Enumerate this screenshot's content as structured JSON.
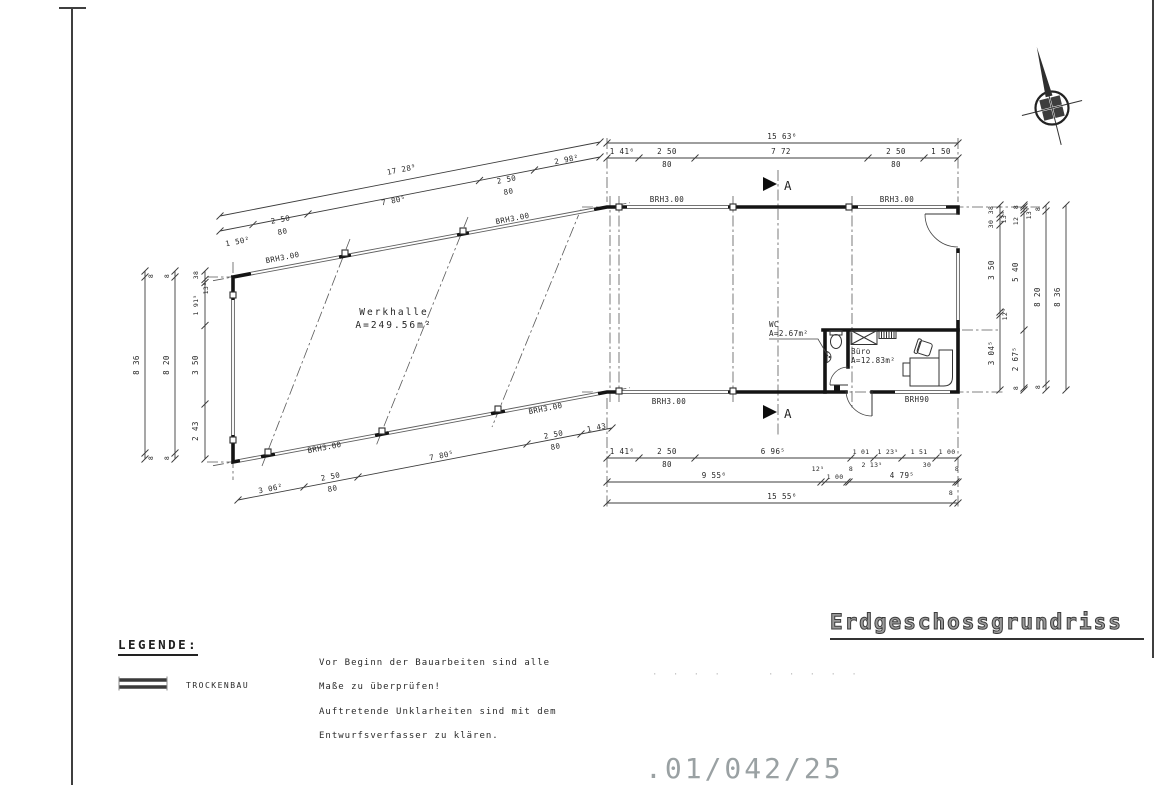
{
  "sheet": {
    "title": "Erdgeschossgrundriss",
    "drawing_number": ".01/042/25",
    "dots_left": "· · · ·",
    "dots_right": "· · · · ·"
  },
  "legend": {
    "heading": "LEGENDE:",
    "item_trockenbau": "TROCKENBAU"
  },
  "notes": {
    "line1": "Vor Beginn der Bauarbeiten sind alle",
    "line2": "Maße zu überprüfen!",
    "line3": "Auftretende Unklarheiten sind mit dem",
    "line4": "Entwurfsverfasser zu klären."
  },
  "rooms": {
    "werkhalle_name": "Werkhalle",
    "werkhalle_area": "A=249.56m²",
    "wc_name": "WC",
    "wc_area": "A=2.67m²",
    "buero_name": "Büro",
    "buero_area": "A=12.83m²"
  },
  "walls": {
    "brh300": "BRH3.00",
    "brh90": "BRH90"
  },
  "section": {
    "label": "A"
  },
  "dims": {
    "tl_total": "17 28⁹",
    "tl": [
      "1 50²",
      "2 50",
      "80",
      "7 80⁵",
      "2 50",
      "80",
      "2 98²"
    ],
    "tr_total": "15 63⁶",
    "tr": [
      "1 41⁶",
      "2 50",
      "80",
      "7 72",
      "2 50",
      "80",
      "1 50"
    ],
    "bl": [
      "3 06²",
      "2 50",
      "80",
      "7 80⁵",
      "2 50",
      "80",
      "1 43"
    ],
    "br1": [
      "1 41⁶",
      "2 50",
      "80",
      "6 96⁵",
      "1 01",
      "1 23⁵",
      "2 13⁵",
      "1 51",
      "30",
      "1 00"
    ],
    "br2": [
      "9 55⁶",
      "12⁵",
      "1 00",
      "8",
      "4 79⁵",
      "8"
    ],
    "br3": [
      "15 55⁶",
      "8"
    ],
    "l1": [
      "38",
      "13⁵",
      "1 91⁵",
      "3 50",
      "2 43"
    ],
    "l2": [
      "8",
      "8 20",
      "8"
    ],
    "l3": [
      "8",
      "8 36",
      "8"
    ],
    "r1": [
      "38",
      "13⁵",
      "30",
      "3 50",
      "12⁵",
      "3 04⁵"
    ],
    "r2": [
      "8",
      "13⁵",
      "12",
      "5 40",
      "2 67⁵",
      "8"
    ],
    "r3": [
      "8",
      "8 20",
      "8"
    ],
    "r4": "8 36"
  }
}
